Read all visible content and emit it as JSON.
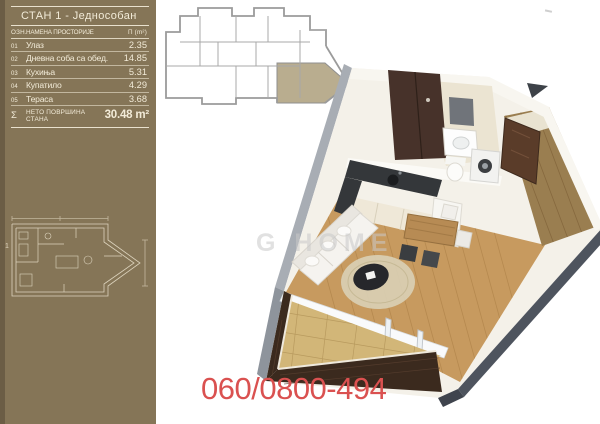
{
  "panel": {
    "table": {
      "title": "СТАН 1 - Једнособан",
      "headers": {
        "code": "ОЗН.",
        "name": "НАМЕНА ПРОСТОРИЈЕ",
        "area": "П (m²)"
      },
      "rows": [
        {
          "num": "01",
          "name": "Улаз",
          "area": "2.35"
        },
        {
          "num": "02",
          "name": "Дневна соба са обед.",
          "area": "14.85"
        },
        {
          "num": "03",
          "name": "Кухиња",
          "area": "5.31"
        },
        {
          "num": "04",
          "name": "Купатило",
          "area": "4.29"
        },
        {
          "num": "05",
          "name": "Тераса",
          "area": "3.68"
        }
      ],
      "total": {
        "sigma": "Σ",
        "label": "НЕТО ПОВРШИНА СТАНА",
        "value": "30.48 m²"
      }
    },
    "floorplan_label": "1"
  },
  "contact": {
    "phone": "060/0800-494"
  },
  "watermark": {
    "text": "G HOME"
  },
  "colors": {
    "panel_brown": "#857557",
    "panel_edge": "#6b5d45",
    "table_text": "#f2ebd8",
    "keyplan_highlight": "#b9ad8f",
    "phone_red": "#da5150",
    "wood_floor": "#c79a5f",
    "terrace_brick": "#3b2a1e",
    "kitchen_counter": "#34373a",
    "slate_edge": "#4e545e",
    "watermark_gray": "#c9c9c9"
  }
}
